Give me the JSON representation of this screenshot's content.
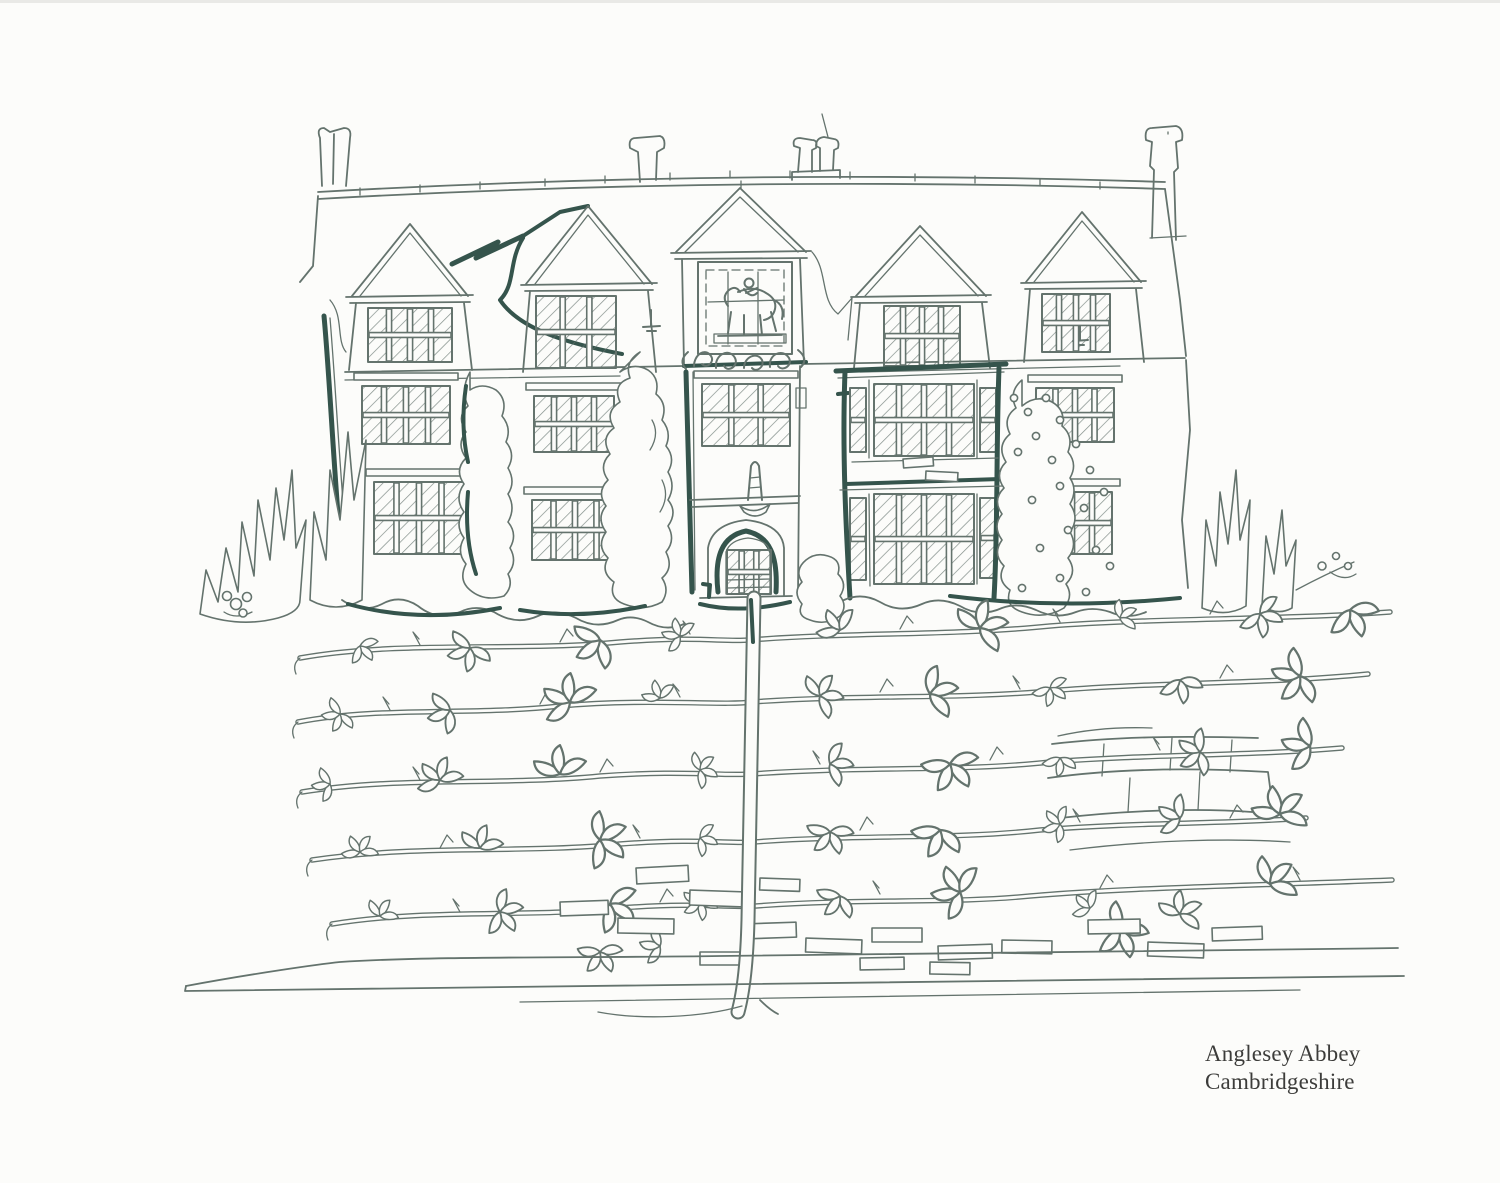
{
  "artwork": {
    "caption": {
      "line1": "Anglesey Abbey",
      "line2": "Cambridgeshire"
    }
  },
  "colors": {
    "paper": "#fcfcfa",
    "ink": "#64736d",
    "accent": "#35544c",
    "caption-ink": "#3c3c3a",
    "artifact": "#d9d9d5"
  }
}
